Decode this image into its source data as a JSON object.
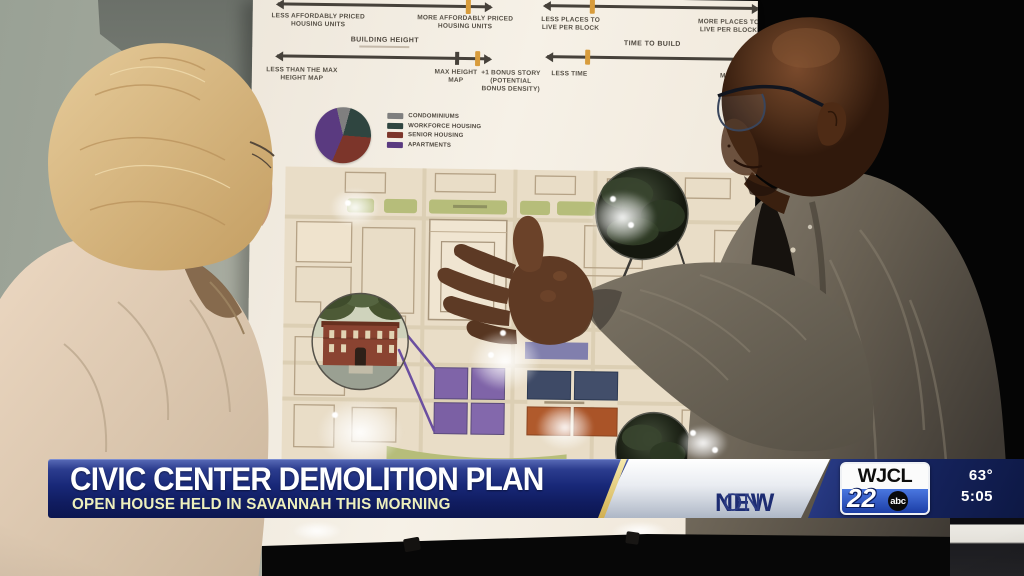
{
  "poster": {
    "spectrum_affordability": {
      "left": "LESS AFFORDABLY PRICED HOUSING UNITS",
      "right": "MORE AFFORDABLY PRICED HOUSING UNITS"
    },
    "spectrum_density": {
      "left": "LESS PLACES TO LIVE PER BLOCK",
      "right": "MORE PLACES TO LIVE PER BLOCK"
    },
    "spectrum_height": {
      "title": "BUILDING HEIGHT",
      "left": "LESS THAN THE MAX HEIGHT MAP",
      "mid": "MAX HEIGHT MAP",
      "right": "+1 BONUS STORY (POTENTIAL BONUS DENSITY)"
    },
    "spectrum_time": {
      "title": "TIME TO BUILD",
      "left": "LESS TIME",
      "right": "MORE TIME"
    },
    "legend": {
      "items": [
        {
          "label": "CONDOMINIUMS",
          "color": "#7f7f7f"
        },
        {
          "label": "WORKFORCE HOUSING",
          "color": "#2f4540"
        },
        {
          "label": "SENIOR HOUSING",
          "color": "#7c352a"
        },
        {
          "label": "APARTMENTS",
          "color": "#5a3a80"
        }
      ]
    }
  },
  "chart_data": {
    "type": "pie",
    "categories": [
      "CONDOMINIUMS",
      "WORKFORCE HOUSING",
      "SENIOR HOUSING",
      "APARTMENTS"
    ],
    "values": [
      8,
      22,
      30,
      40
    ],
    "colors": [
      "#7f7f7f",
      "#2f4540",
      "#7c352a",
      "#5a3a80"
    ],
    "title": "",
    "legend_position": "right"
  },
  "banner": {
    "headline": "CIVIC CENTER DEMOLITION PLAN",
    "subheadline": "OPEN HOUSE HELD IN SAVANNAH THIS MORNING",
    "promo_bold": "NEW",
    "promo_rest": "ON",
    "station": {
      "call_letters": "WJCL",
      "channel": "22",
      "network": "abc"
    },
    "temperature": "63°",
    "time": "5:05"
  }
}
